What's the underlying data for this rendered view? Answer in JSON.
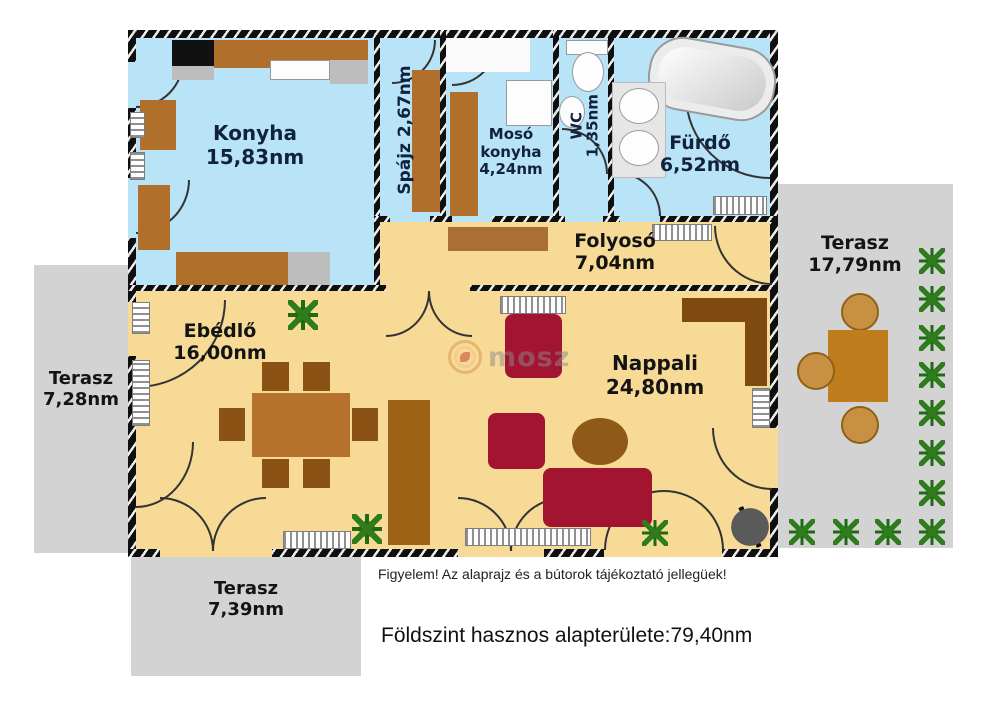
{
  "rooms": {
    "konyha": {
      "name": "Konyha",
      "area": "15,83nm"
    },
    "spajz": {
      "name": "Spájz",
      "area": "2,67nm"
    },
    "moso_konyha": {
      "name": "Mosó konyha",
      "area": "4,24nm"
    },
    "wc": {
      "name": "WC",
      "area": "1,35nm"
    },
    "furdo": {
      "name": "Fürdő",
      "area": "6,52nm"
    },
    "folyoso": {
      "name": "Folyosó",
      "area": "7,04nm"
    },
    "ebedlo": {
      "name": "Ebédlő",
      "area": "16,00nm"
    },
    "nappali": {
      "name": "Nappali",
      "area": "24,80nm"
    }
  },
  "terraces": {
    "left": {
      "name": "Terasz",
      "area": "7,28nm"
    },
    "right": {
      "name": "Terasz",
      "area": "17,79nm"
    },
    "bottom": {
      "name": "Terasz",
      "area": "7,39nm"
    }
  },
  "footer": {
    "disclaimer": "Figyelem! Az alaprajz és a bútorok tájékoztató jellegüek!",
    "total_area": "Földszint hasznos alapterülete:79,40nm"
  },
  "watermark": {
    "text": "mosz"
  },
  "colors": {
    "wet_room_floor": "#b9e4f8",
    "living_floor": "#f7da95",
    "terrace": "#d3d3d3",
    "wall": "#0f0f0f",
    "furniture_wood": "#b06f2a",
    "furniture_wood_dark": "#8a5314",
    "sofa_red": "#a31430",
    "label_text": "#10223d"
  }
}
